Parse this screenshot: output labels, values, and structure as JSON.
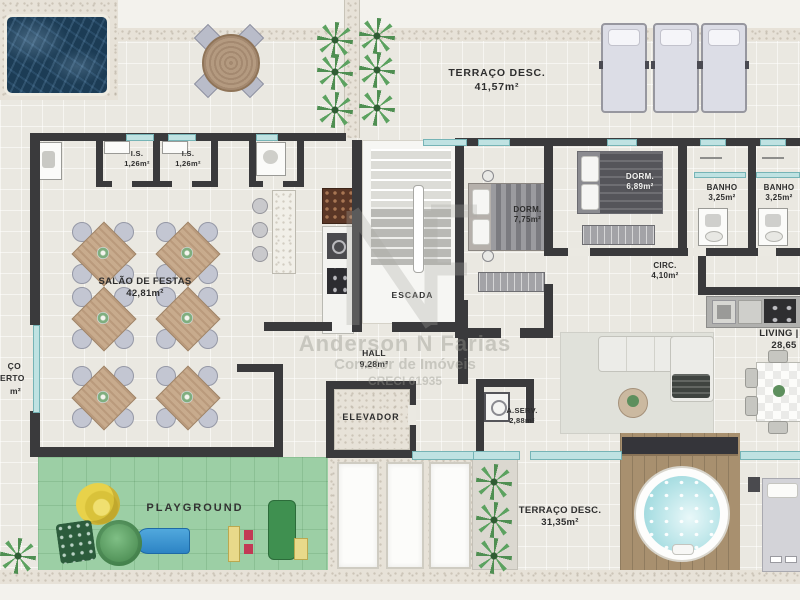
{
  "watermark": {
    "line1": "Anderson N Farias",
    "line2": "Corretor de Imóveis",
    "line3": "CRECI 61935",
    "monogram": "NF"
  },
  "rooms": {
    "terraco_top": {
      "label": "TERRAÇO DESC.",
      "area": "41,57m²"
    },
    "is1": {
      "label": "I.S.",
      "area": "1,26m²"
    },
    "is2": {
      "label": "I.S.",
      "area": "1,26m²"
    },
    "salao": {
      "label": "SALÃO DE FESTAS",
      "area": "42,81m²"
    },
    "escada": {
      "label": "ESCADA"
    },
    "hall": {
      "label": "HALL",
      "area": "9,28m²"
    },
    "elevador": {
      "label": "ELEVADOR"
    },
    "dorm1": {
      "label": "DORM.",
      "area": "7,75m²"
    },
    "dorm2": {
      "label": "DORM.",
      "area": "6,89m²"
    },
    "banho1": {
      "label": "BANHO",
      "area": "3,25m²"
    },
    "banho2": {
      "label": "BANHO",
      "area": "3,25m²"
    },
    "circ": {
      "label": "CIRC.",
      "area": "4,10m²"
    },
    "living": {
      "label": "LIVING | C",
      "area": "28,65"
    },
    "aserv": {
      "label": "A.SERV.",
      "area": "2,88m²"
    },
    "terraco_bottom": {
      "label": "TERRAÇO DESC.",
      "area": "31,35m²"
    },
    "playground": {
      "label": "PLAYGROUND"
    },
    "terraco_left": {
      "l1": "ÇO",
      "l2": "ERTO",
      "l3": "m²"
    }
  },
  "colors": {
    "wall": "#3a3a3c",
    "pool_water": "#1c3c55",
    "playground_green": "#9ccfa5",
    "glass": "#bfe2e2",
    "deck_wood": "#a8906f",
    "jacuzzi_water": "#bfe8ea",
    "floor": "#eae8e1"
  }
}
